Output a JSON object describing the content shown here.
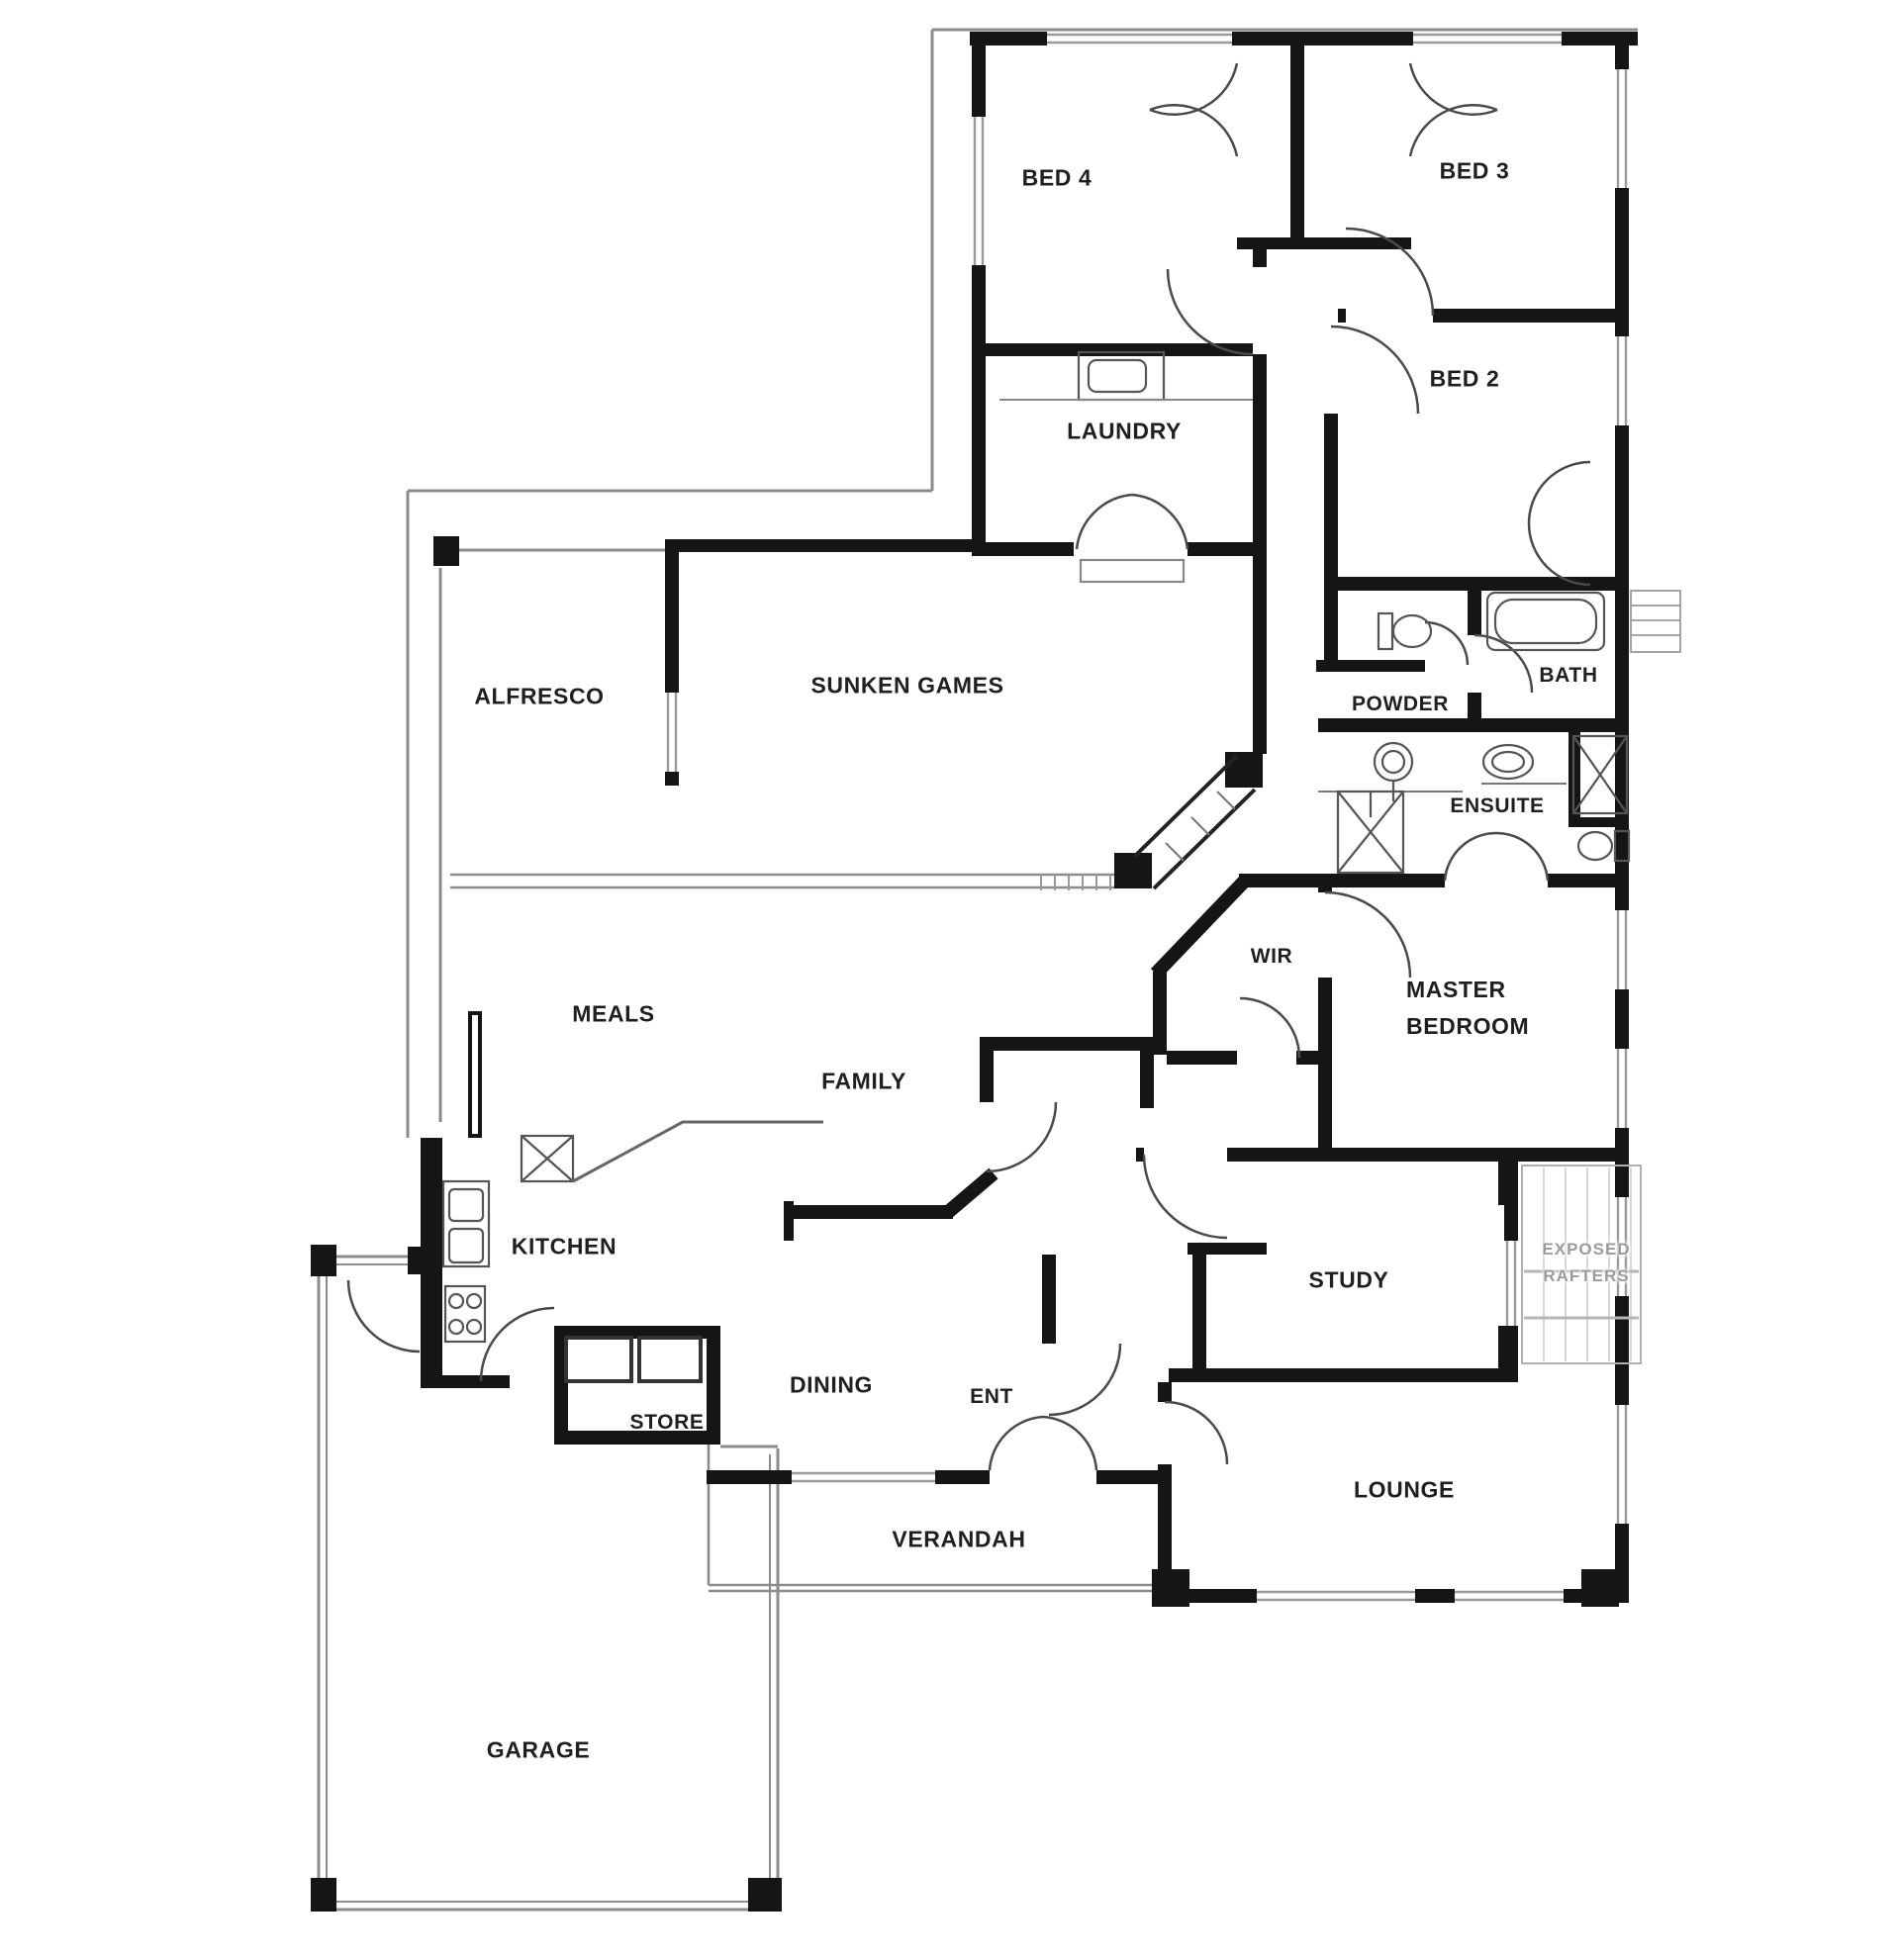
{
  "plan": {
    "type": "residential floor plan",
    "colors": {
      "background": "#ffffff",
      "wall": "#151515",
      "window": "#9a9a9a",
      "site_line": "#8c8c8c",
      "door_arc": "#4a4a4a",
      "fixture": "#555555",
      "label": "#1f1f1f",
      "muted_label": "#9b9b9b"
    }
  },
  "rooms": {
    "bed4": "BED 4",
    "bed3": "BED 3",
    "bed2": "BED 2",
    "laundry": "LAUNDRY",
    "alfresco": "ALFRESCO",
    "sunken_games": "SUNKEN GAMES",
    "powder": "POWDER",
    "bath": "BATH",
    "ensuite": "ENSUITE",
    "wir": "WIR",
    "master_line1": "MASTER",
    "master_line2": "BEDROOM",
    "meals": "MEALS",
    "family": "FAMILY",
    "kitchen": "KITCHEN",
    "study": "STUDY",
    "exposed_line1": "EXPOSED",
    "exposed_line2": "RAFTERS",
    "dining": "DINING",
    "ent": "ENT",
    "store": "STORE",
    "lounge": "LOUNGE",
    "verandah": "VERANDAH",
    "garage": "GARAGE"
  }
}
